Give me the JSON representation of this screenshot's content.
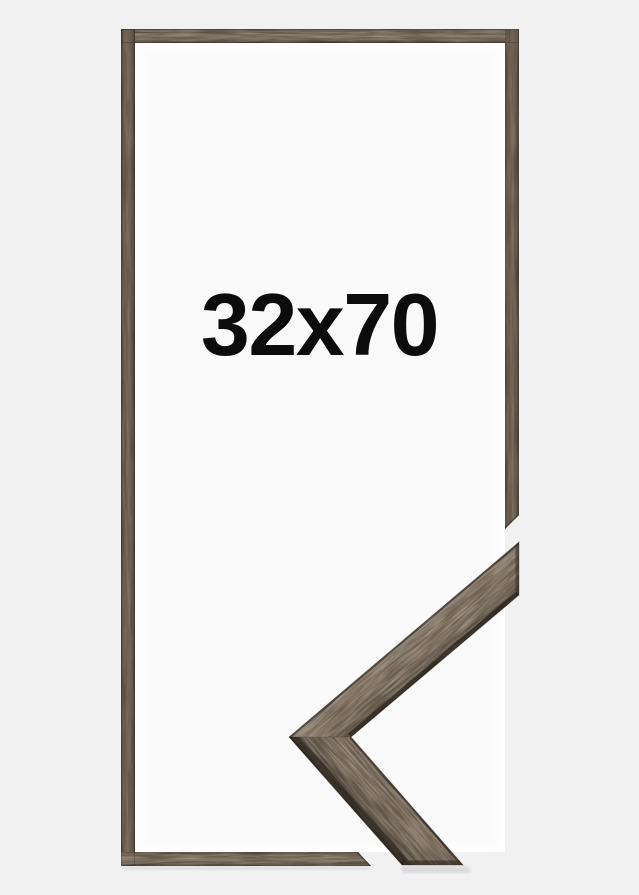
{
  "product": {
    "item": "picture-frame",
    "size_label": "32x70",
    "colors": {
      "background": "#f1f1f2",
      "frame_interior": "#fafafb",
      "frame_wood": "#55493c",
      "sample_wood": "#5d5043",
      "wood_shadow_edge": "#2b2118",
      "label_text": "#0c0c0c"
    }
  }
}
